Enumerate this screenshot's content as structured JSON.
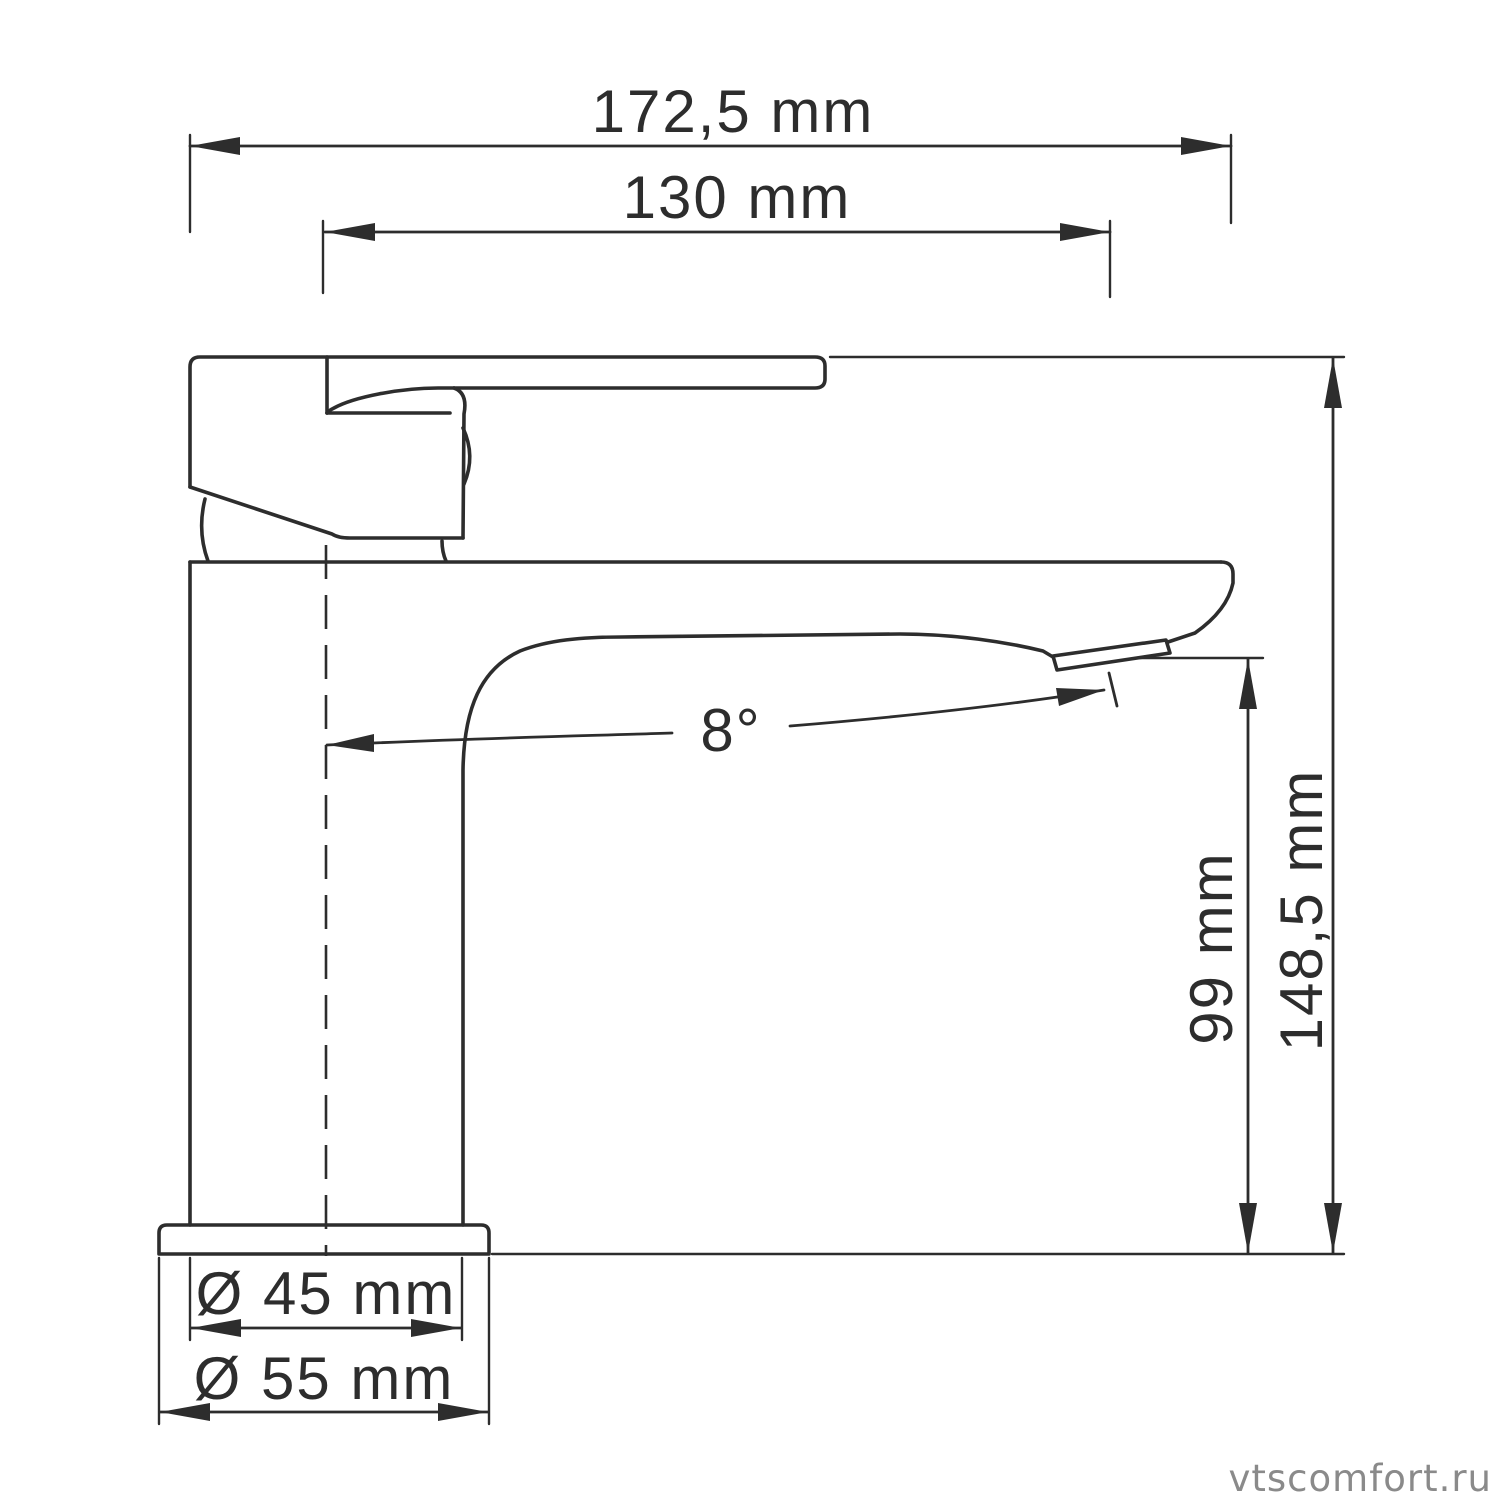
{
  "colors": {
    "line": "#2d2d2d",
    "text": "#2d2d2d",
    "background": "#ffffff"
  },
  "labels": {
    "overall_width": "172,5 mm",
    "reach": "130 mm",
    "angle": "8°",
    "spout_height": "99 mm",
    "total_height": "148,5 mm",
    "diameter_body": "Ø 45 mm",
    "diameter_base": "Ø 55 mm"
  },
  "watermark": {
    "text": "vtscomfort.ru",
    "color": "#8a8a8a"
  }
}
